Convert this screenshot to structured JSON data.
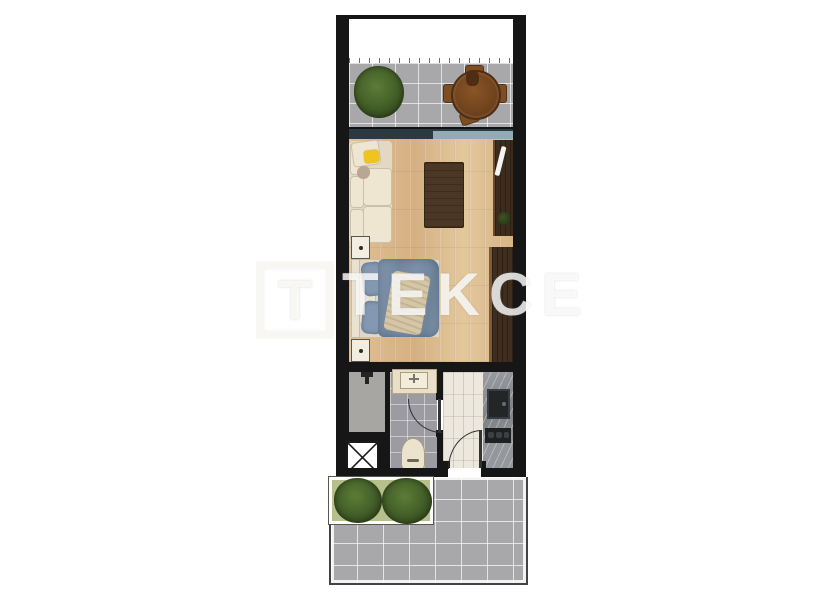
{
  "watermark": {
    "logo_letter": "T",
    "brand_text": "TEKCE"
  },
  "colors": {
    "wall": "#161616",
    "floor-wood": "#dcba8c",
    "wood-dark": "#4c3624",
    "wardrobe": "#3f2e1f",
    "tv-unit": "#3d2c1d",
    "tile-gray": "#a8a8ab",
    "bath-tile": "#9c9ba1",
    "kitchen-tile": "#ece8de",
    "counter-marble": "#8e9196",
    "sofa-beige": "#e3d9c2",
    "pillow-yellow": "#f0c41f",
    "bed-blue": "#7b90a9",
    "throw-beige": "#d5c6a6",
    "cream-fixture": "#ece3ce",
    "planter-green": "#b5c08b",
    "bush-green": "#46622a",
    "glass-dark": "#2b3a41",
    "glass-light": "#93abb7",
    "appliance-dark": "#232527"
  }
}
